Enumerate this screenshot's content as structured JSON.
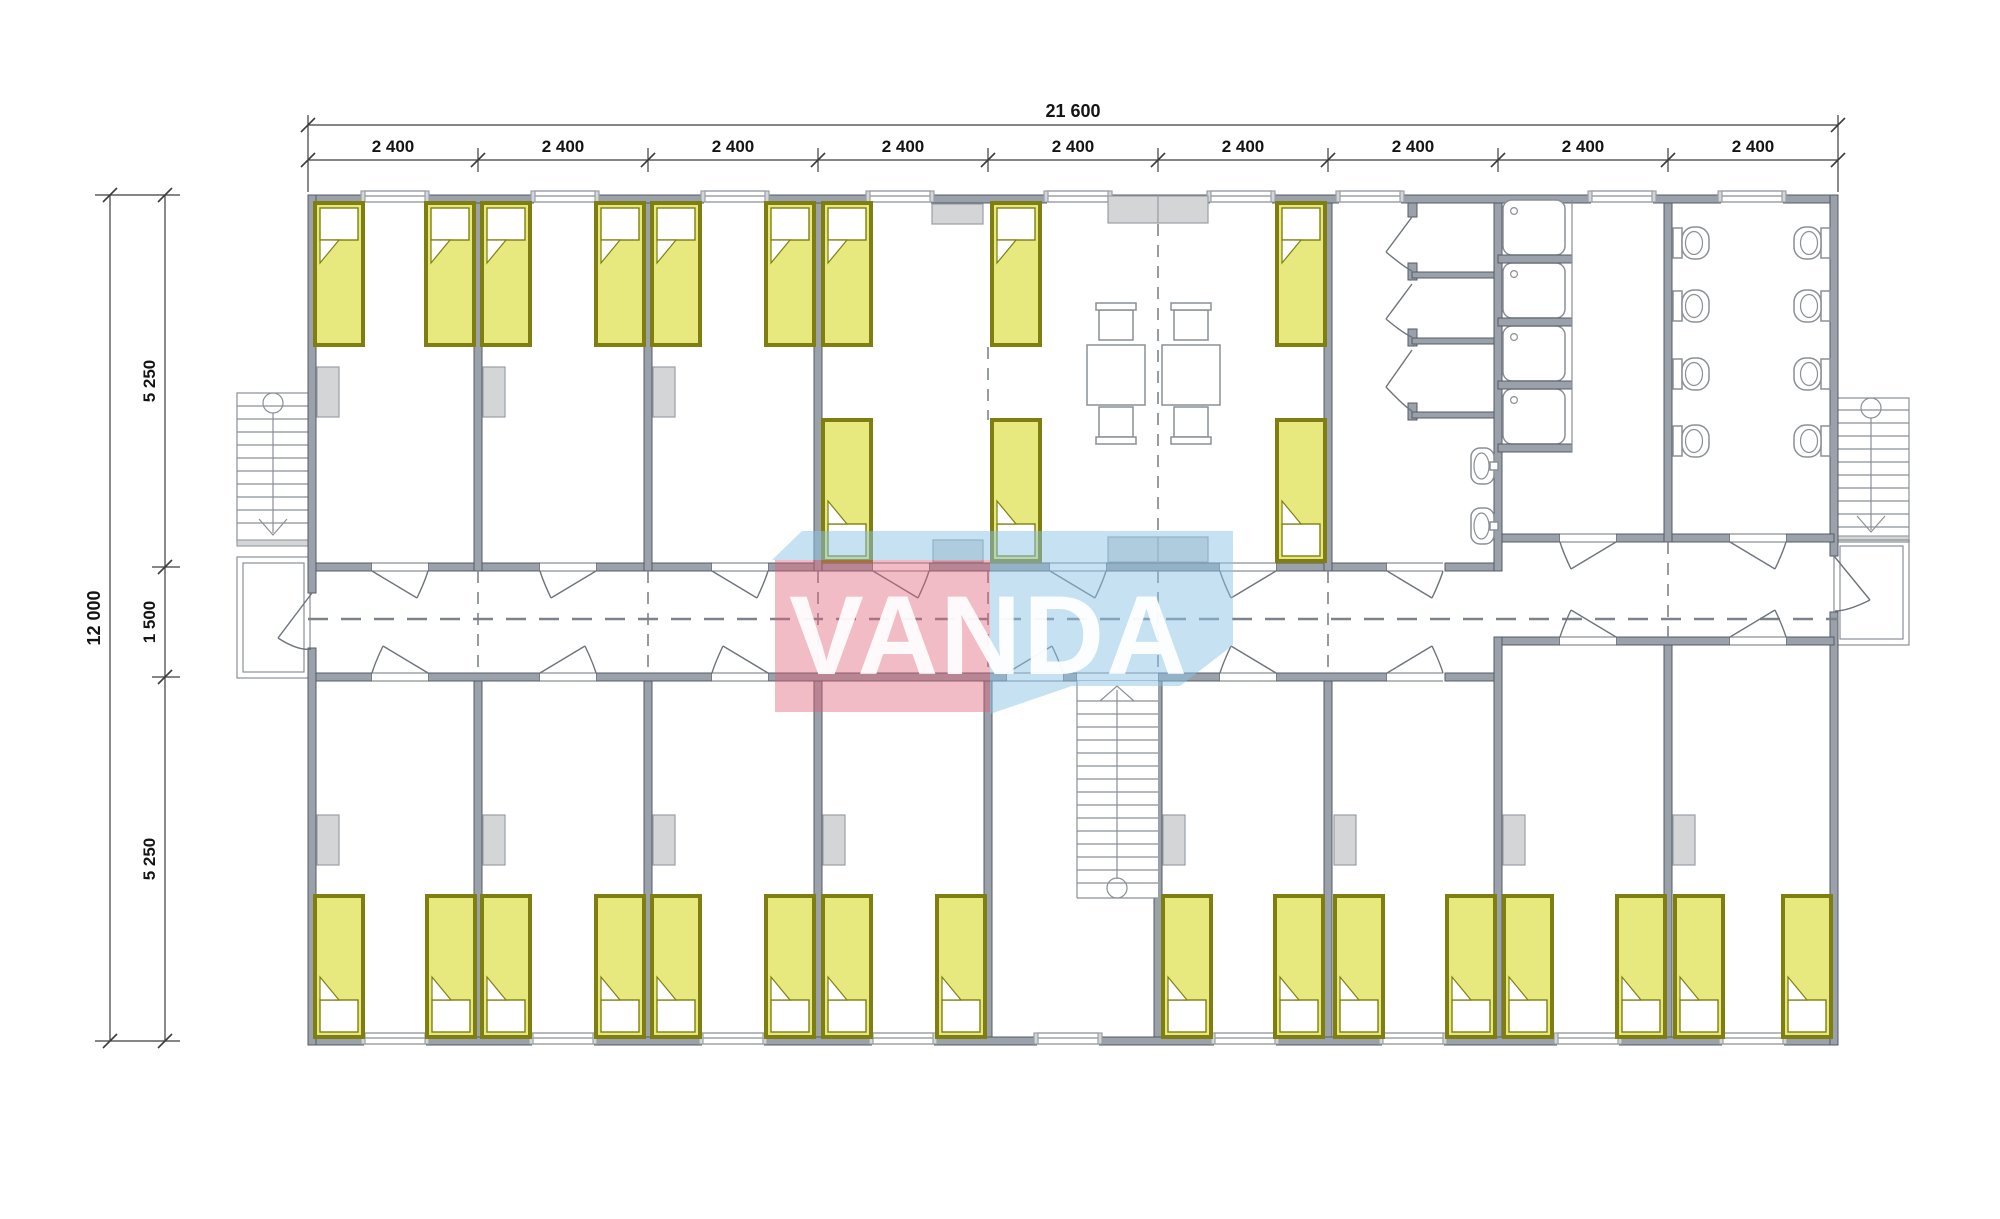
{
  "watermark": {
    "text": "VANDA",
    "pink_color": "#e05f78",
    "blue_color": "#8cc3e6"
  },
  "dimensions": {
    "top": {
      "total": "21 600",
      "segments": [
        "2 400",
        "2 400",
        "2 400",
        "2 400",
        "2 400",
        "2 400",
        "2 400",
        "2 400",
        "2 400"
      ]
    },
    "left": {
      "total": "12 000",
      "segments": [
        "5 250",
        "1 500",
        "5 250"
      ]
    }
  },
  "colors": {
    "wall": "#9ba1ab",
    "wall_stroke": "#565b63",
    "line": "#6e747c",
    "bed_fill": "#e7e87e",
    "bed_border": "#7e7f10",
    "furniture": "#d3d5d7",
    "pink": "#e05f78",
    "blue": "#8cc3e6"
  },
  "symbols": {
    "bed": "single-bed",
    "wardrobe": "wardrobe-cabinet",
    "table": "dining-table",
    "chair": "chair",
    "shower_stall": "shower-cubicle",
    "shower_tray": "shower-tray",
    "sink": "washbasin",
    "wc": "toilet",
    "stairs": "staircase",
    "door": "swing-door"
  }
}
